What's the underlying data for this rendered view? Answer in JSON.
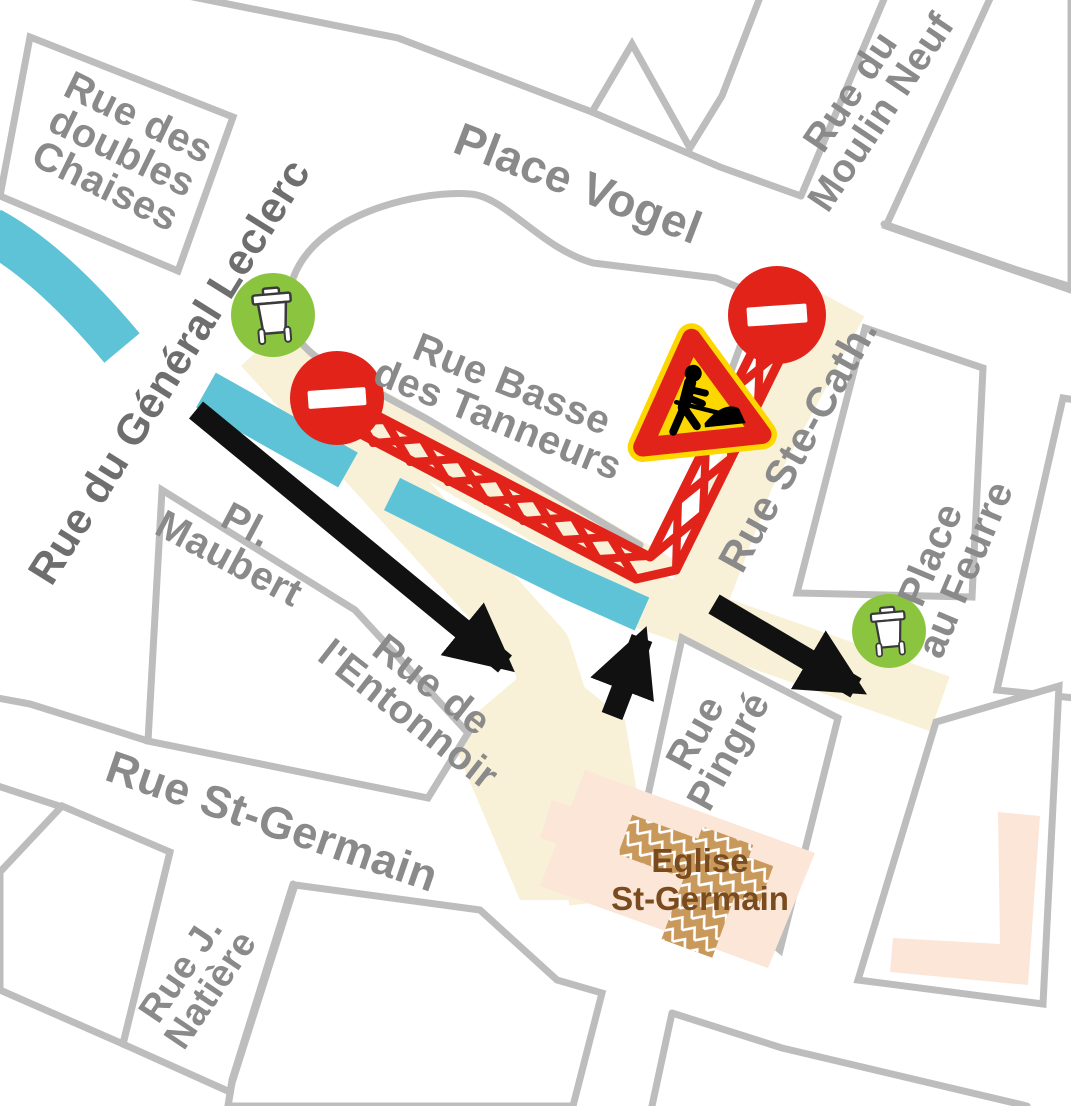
{
  "labels": {
    "doubles_chaises": {
      "lines": [
        "Rue des",
        "doubles",
        "Chaises"
      ]
    },
    "place_vogel": {
      "lines": [
        "Place Vogel"
      ]
    },
    "moulin_neuf": {
      "lines": [
        "Rue du",
        "Moulin Neuf"
      ]
    },
    "general_leclerc": {
      "lines": [
        "Rue du Général Leclerc"
      ]
    },
    "basse_tanneurs": {
      "lines": [
        "Rue Basse",
        "des Tanneurs"
      ]
    },
    "pl_maubert": {
      "lines": [
        "Pl.",
        "Maubert"
      ]
    },
    "entonnoir": {
      "lines": [
        "Rue de",
        "l'Entonnoir"
      ]
    },
    "st_germain": {
      "lines": [
        "Rue St-Germain"
      ]
    },
    "natiere": {
      "lines": [
        "Rue J.",
        "Natière"
      ]
    },
    "ste_cath": {
      "lines": [
        "Rue Ste-Cath."
      ]
    },
    "au_feurre": {
      "lines": [
        "Place",
        "au Feurre"
      ]
    },
    "pingre": {
      "lines": [
        "Rue",
        "Pingré"
      ]
    },
    "eglise": {
      "lines": [
        "Eglise",
        "St-Germain"
      ]
    }
  },
  "icons": {
    "no_entry": "no-entry-sign",
    "roadworks": "roadworks-sign",
    "waste_bin": "waste-bin-badge"
  },
  "colors": {
    "road": "#f8f1d7",
    "river": "#5fc3d7",
    "red": "#e2231a",
    "yellow": "#fcd800",
    "green": "#8bc53f",
    "line": "#bdbdbd",
    "label": "#8a8a8a",
    "label-dark": "#6e6e6e",
    "brown": "#7a4b1e",
    "pink": "#fbe6d8",
    "tan": "#c9995c",
    "black": "#111111"
  }
}
